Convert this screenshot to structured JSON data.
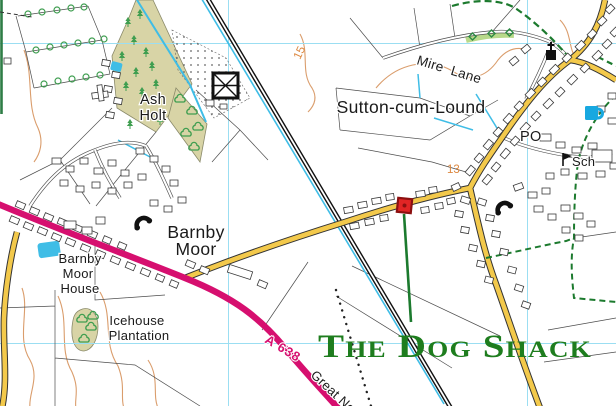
{
  "map": {
    "annotation": {
      "title": "The Dog Shack",
      "color": "#1e7d1e"
    },
    "marker": {
      "shape": "red-square",
      "fill": "#e12525",
      "border": "#8c1010"
    },
    "places": {
      "sutton": "Sutton-cum-Lound",
      "barnby_line1": "Barnby",
      "barnby_line2": "Moor",
      "ash_line1": "Ash",
      "ash_line2": "Holt",
      "bmh_line1": "Barnby",
      "bmh_line2": "Moor",
      "bmh_line3": "House",
      "ice_line1": "Icehouse",
      "ice_line2": "Plantation"
    },
    "roads": {
      "a638": "A 638",
      "great_north": "Great Nor",
      "mire_lane": "Mire Lane"
    },
    "pois": {
      "post_office": "PO",
      "school": "Sch"
    },
    "contour_labels": {
      "c15": "15",
      "c13": "13"
    },
    "colors": {
      "primary_road": "#d60f6f",
      "minor_road": "#f3c94b",
      "water": "#3fbde6",
      "woodland": "#d8d4a6",
      "grid": "#9bdef2",
      "contour": "#da9d6c",
      "green_route": "#1c7a2e"
    },
    "icons": [
      "church-icon",
      "telephone-icon",
      "pub-icon",
      "school-flag-icon",
      "glasshouse-icon"
    ]
  }
}
